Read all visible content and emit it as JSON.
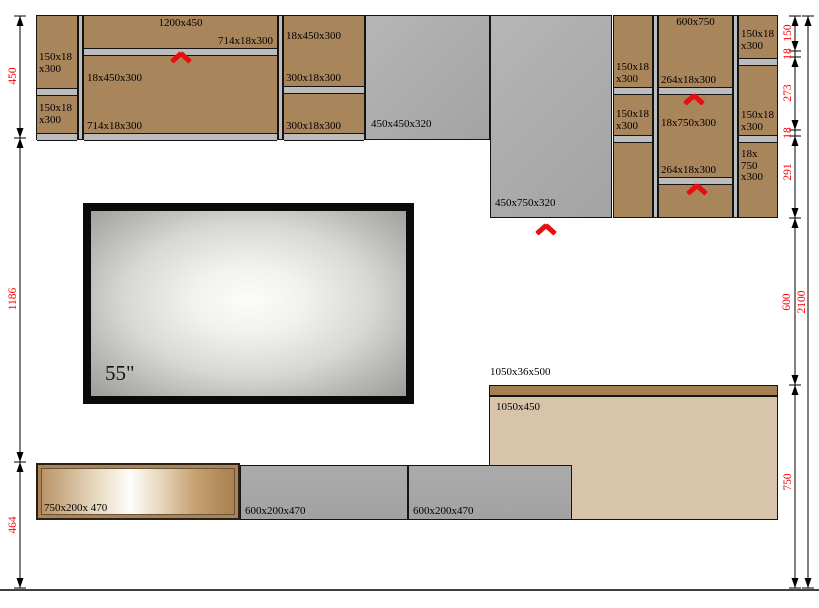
{
  "upper_cabinets": {
    "left_column": {
      "shelf_label_1": "150x18 x300",
      "shelf_label_2": "150x18 x300"
    },
    "wide_cabinet": {
      "name_label": "1200x450",
      "top_shelf_label": "714x18x300",
      "side_panel_label": "18x450x300",
      "bottom_shelf_label": "714x18x300"
    },
    "right_column": {
      "side_panel_label": "18x450x300",
      "shelf_label_1": "300x18x300",
      "shelf_label_2": "300x18x300"
    }
  },
  "side_panels": {
    "small_label": "450x450x320",
    "large_label": "450x750x320"
  },
  "tall_cabinet": {
    "left_column": {
      "shelf_label_1": "150x18 x300",
      "shelf_label_2": "150x18 x300"
    },
    "center_column": {
      "name_label": "600x750",
      "shelf_label_1": "264x18x300",
      "side_panel_label": "18x750x300",
      "shelf_label_2": "264x18x300"
    },
    "right_column": {
      "shelf_label_1": "150x18 x300",
      "shelf_label_2": "150x18 x300",
      "side_panel_label": "18x 750 x300"
    }
  },
  "tv": {
    "size_label": "55\""
  },
  "base_cabinets": {
    "drawer_label": "750x200x 470",
    "cabinet_label_1": "600x200x470",
    "cabinet_label_2": "600x200x470",
    "countertop_label": "1050x36x500",
    "back_panel_label": "1050x450"
  },
  "dimensions": {
    "left": [
      "450",
      "1186",
      "464"
    ],
    "right": [
      "150",
      "18",
      "273",
      "18",
      "291",
      "600",
      "750"
    ],
    "overall_height": "2100"
  },
  "colors": {
    "wood": "#a9855c",
    "panel_gray": "#ababab",
    "shelf_gray": "#bcbcbc",
    "beige_panel": "#d8c4ab",
    "countertop": "#a57e51",
    "annotation_red": "#e60f0f",
    "dimension_red": "#fb0000"
  }
}
